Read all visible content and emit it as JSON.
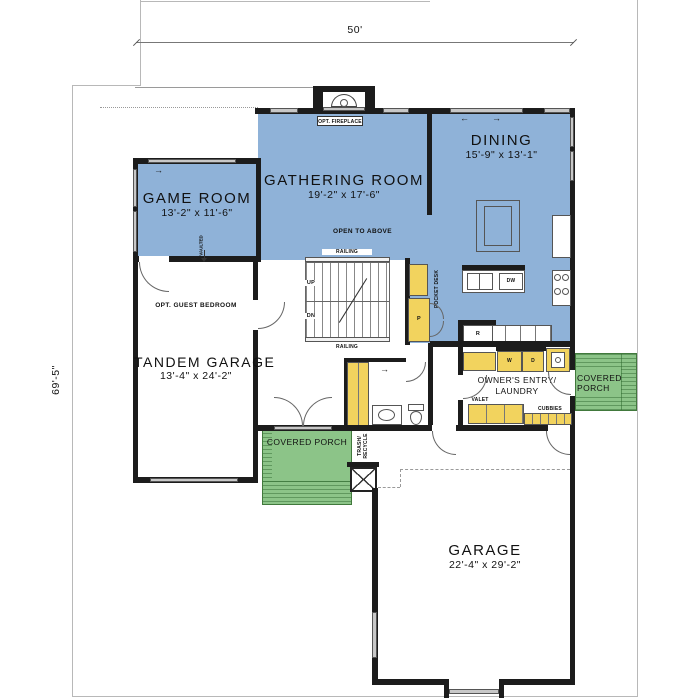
{
  "dims": {
    "top": "50'",
    "left": "69'-5\""
  },
  "rooms": {
    "gathering": {
      "name": "GATHERING ROOM",
      "size": "19'-2\" x 17'-6\""
    },
    "game": {
      "name": "GAME ROOM",
      "size": "13'-2\" x 11'-6\""
    },
    "dining": {
      "name": "DINING",
      "size": "15'-9\" x 13'-1\""
    },
    "tandem_garage": {
      "name": "TANDEM GARAGE",
      "size": "13'-4\" x 24'-2\""
    },
    "garage": {
      "name": "GARAGE",
      "size": "22'-4\" x 29'-2\""
    },
    "owners_entry": {
      "line1": "OWNER'S ENTRY/",
      "line2": "LAUNDRY"
    },
    "porch_left": {
      "name": "COVERED PORCH"
    },
    "porch_right": {
      "line1": "COVERED",
      "line2": "PORCH"
    }
  },
  "labels": {
    "opt_fireplace": "OPT. FIREPLACE",
    "open_to_above": "OPEN TO ABOVE",
    "railing": "RAILING",
    "up": "UP",
    "dn": "DN",
    "pocket_desk": "POCKET DESK",
    "opt_guest_bedroom": "OPT. GUEST BEDROOM",
    "vaulted": "VAULTED",
    "valet": "VALET",
    "cubbies": "CUBBIES",
    "trash_line1": "TRASH/",
    "trash_line2": "RECYCLE"
  },
  "fixtures": {
    "washer": "W",
    "dryer": "D",
    "dishwasher": "DW",
    "fridge": "R",
    "pantry": "P"
  },
  "icons": {
    "arrow_right": "→",
    "arrow_left": "←"
  },
  "colors": {
    "room_blue": "#8FB2D8",
    "porch_green": "#8CC488",
    "cabinet_yellow": "#F2D35E",
    "wall": "#1C1C1C",
    "window_gray": "#C8C8C8"
  }
}
